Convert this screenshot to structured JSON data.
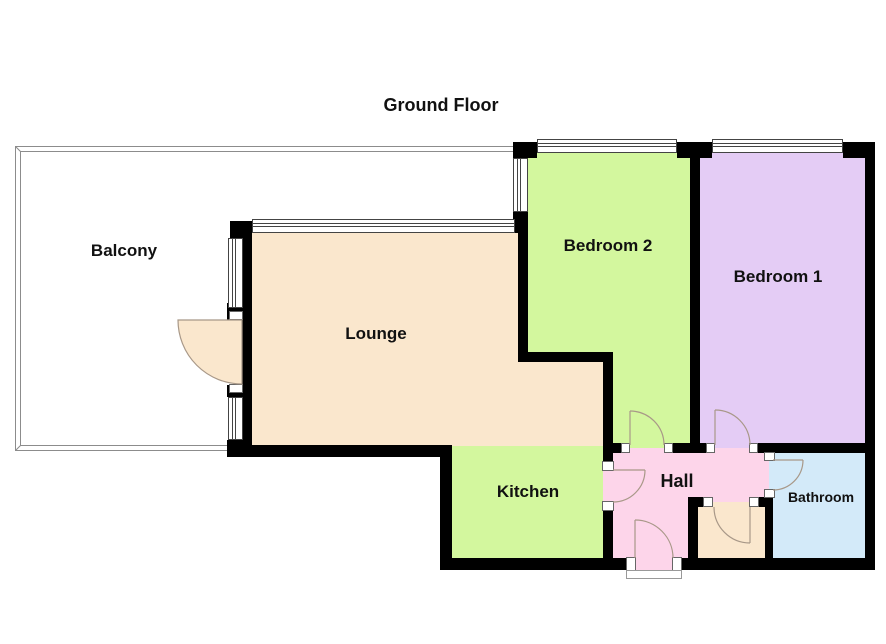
{
  "title": "Ground Floor",
  "rooms": {
    "balcony": {
      "label": "Balcony"
    },
    "lounge": {
      "label": "Lounge"
    },
    "bedroom2": {
      "label": "Bedroom 2"
    },
    "bedroom1": {
      "label": "Bedroom 1"
    },
    "kitchen": {
      "label": "Kitchen"
    },
    "hall": {
      "label": "Hall"
    },
    "bathroom": {
      "label": "Bathroom"
    }
  },
  "colors": {
    "balcony": "#FFFFFF",
    "lounge": "#FAE7CD",
    "bedroom2": "#D3F79E",
    "bedroom1": "#E4CCF5",
    "kitchen": "#D3F79E",
    "hall": "#FDD5EA",
    "bathroom": "#D3EAF9",
    "cupboard": "#FAE7CD",
    "wall": "#000000",
    "balcony_outline": "#8C8C8C",
    "door_arc": "#A89888",
    "window_frame": "#444444",
    "label_text": "#111111"
  }
}
